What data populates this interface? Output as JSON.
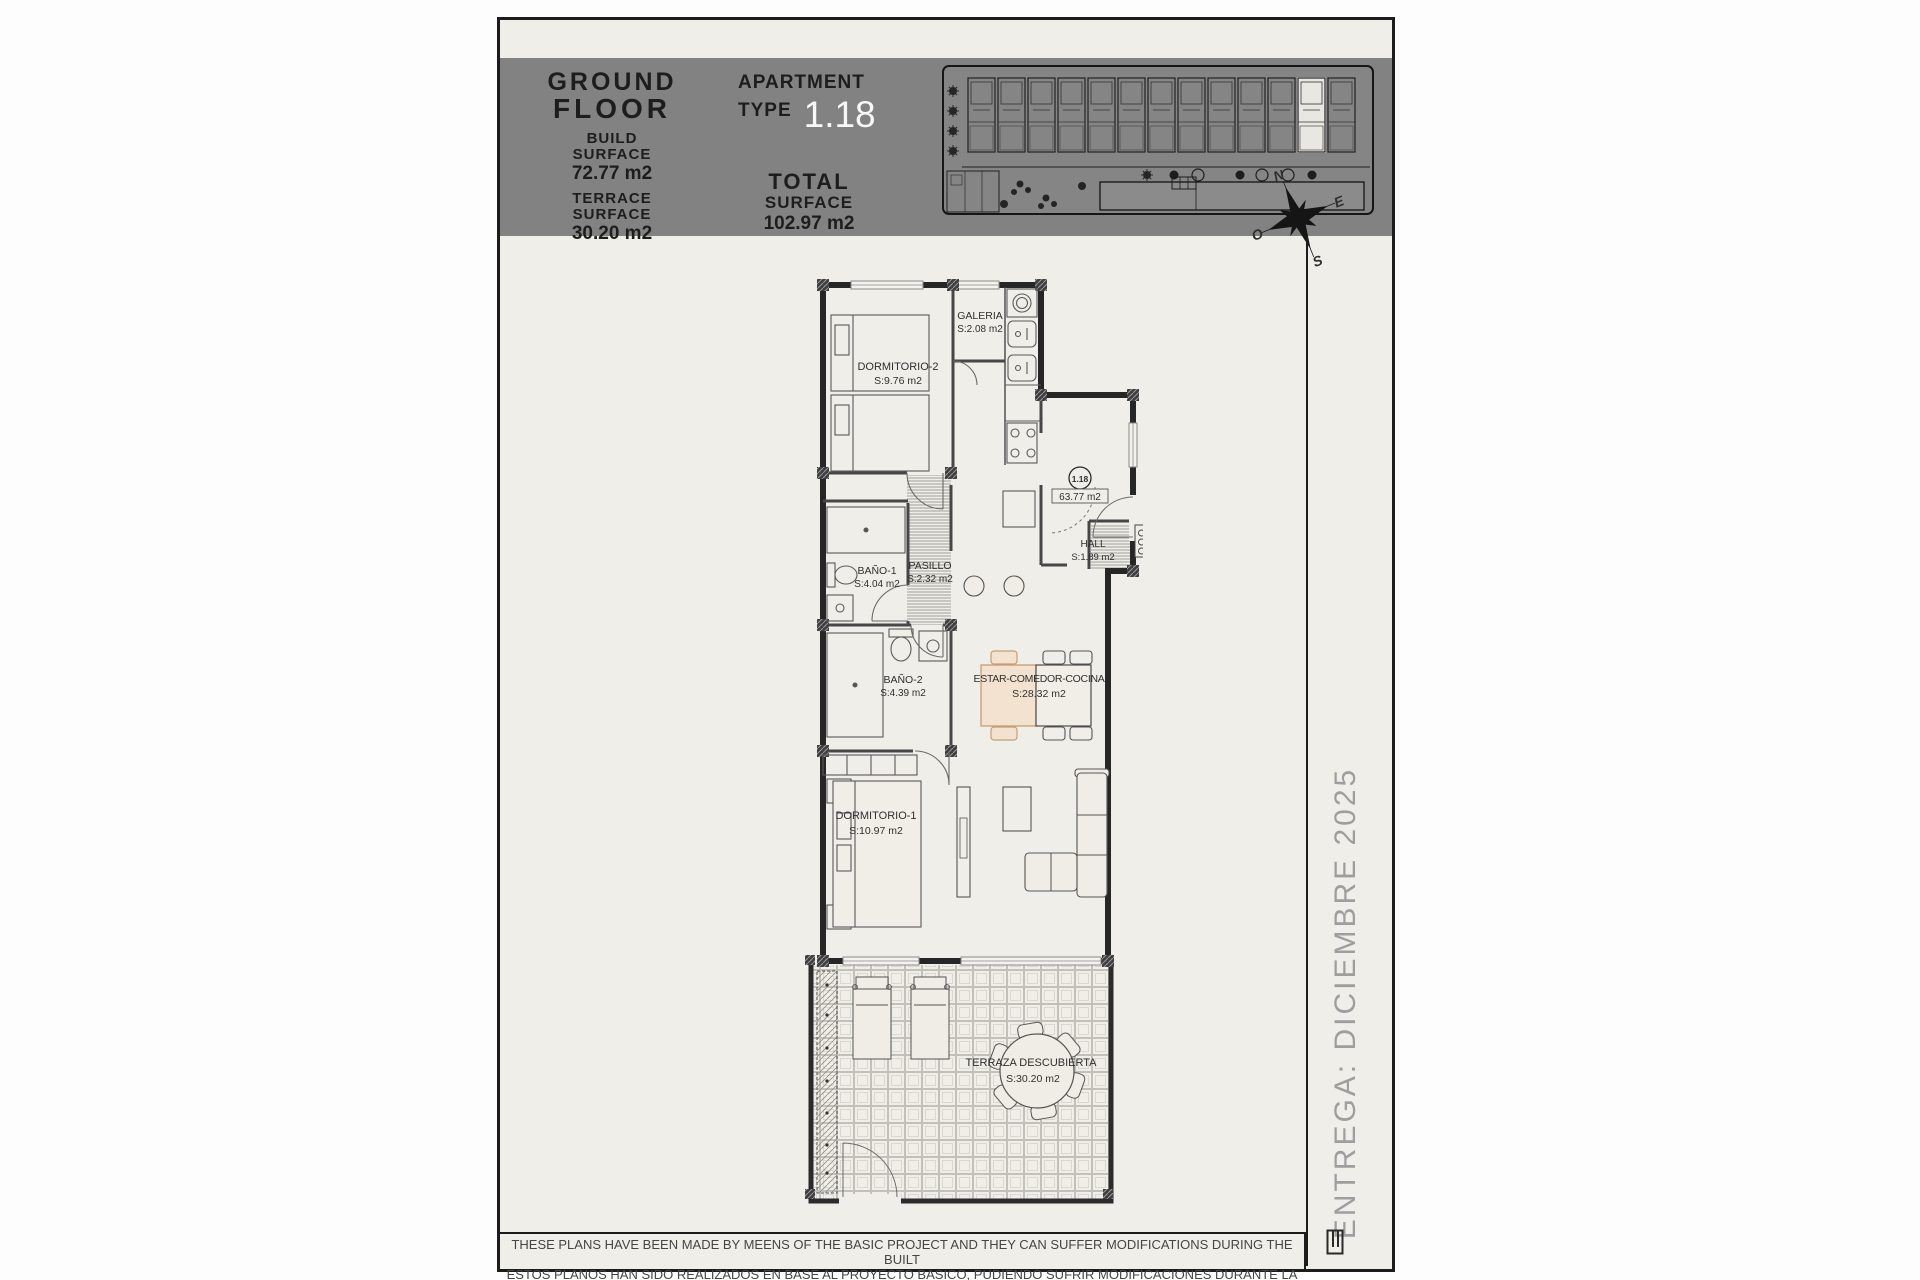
{
  "header": {
    "floor_line1": "GROUND",
    "floor_line2": "FLOOR",
    "build_label1": "BUILD",
    "build_label2": "SURFACE",
    "build_value": "72.77 m2",
    "terrace_label1": "TERRACE",
    "terrace_label2": "SURFACE",
    "terrace_value": "30.20 m2",
    "apartment_label": "APARTMENT",
    "type_label": "TYPE",
    "type_value": "1.18",
    "total_label1": "TOTAL",
    "total_label2": "SURFACE",
    "total_value": "102.97 m2"
  },
  "floorplan": {
    "unit_badge": "1.18",
    "useful_area": "63.77 m2",
    "rooms": [
      {
        "name": "DORMITORIO-2",
        "area": "S:9.76 m2"
      },
      {
        "name": "GALERIA",
        "area": "S:2.08 m2"
      },
      {
        "name": "BAÑO-1",
        "area": "S:4.04 m2"
      },
      {
        "name": "PASILLO",
        "area": "S:2.32 m2"
      },
      {
        "name": "HALL",
        "area": "S:1.89 m2"
      },
      {
        "name": "BAÑO-2",
        "area": "S:4.39 m2"
      },
      {
        "name": "ESTAR-COMEDOR-COCINA",
        "area": "S:28.32 m2"
      },
      {
        "name": "DORMITORIO-1",
        "area": "S:10.97 m2"
      },
      {
        "name": "TERRAZA DESCUBIERTA",
        "area": "S:30.20 m2"
      }
    ],
    "compass": {
      "north": "N",
      "east": "E",
      "south": "S",
      "west": "O"
    }
  },
  "delivery_note": "ENTREGA: DICIEMBRE 2025",
  "footer": {
    "line1": "THESE PLANS HAVE BEEN MADE BY MEENS OF THE BASIC PROJECT AND THEY CAN SUFFER MODIFICATIONS DURING THE BUILT",
    "line2": "ESTOS PLANOS HAN SIDO REALIZADOS EN BASE AL PROYECTO BASICO, PUDIENDO SUFRIR MODIFICACIONES DURANTE LA EJECUCION"
  },
  "colors": {
    "page_background": "#f0eee8",
    "band_background": "#828282",
    "type_value": "#f8f8f8",
    "accent_salmon": "#c79d78",
    "delivery_text": "#9e9e9e"
  }
}
